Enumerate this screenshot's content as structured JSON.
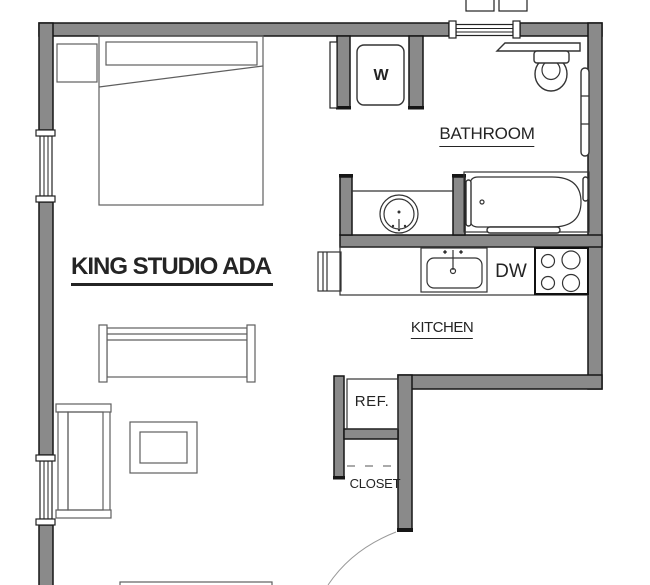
{
  "plan": {
    "title": "KING STUDIO ADA",
    "labels": {
      "bathroom": "BATHROOM",
      "kitchen": "KITCHEN",
      "closet": "CLOSET",
      "washer": "W",
      "dishwasher": "DW",
      "refrigerator": "REF."
    }
  },
  "colors": {
    "wall-fill": "#8a8a8a",
    "wall-stroke": "#161616",
    "furniture-stroke": "#5f5f5f",
    "fixture-stroke": "#333333",
    "text-color": "#242424",
    "bg": "#ffffff"
  }
}
